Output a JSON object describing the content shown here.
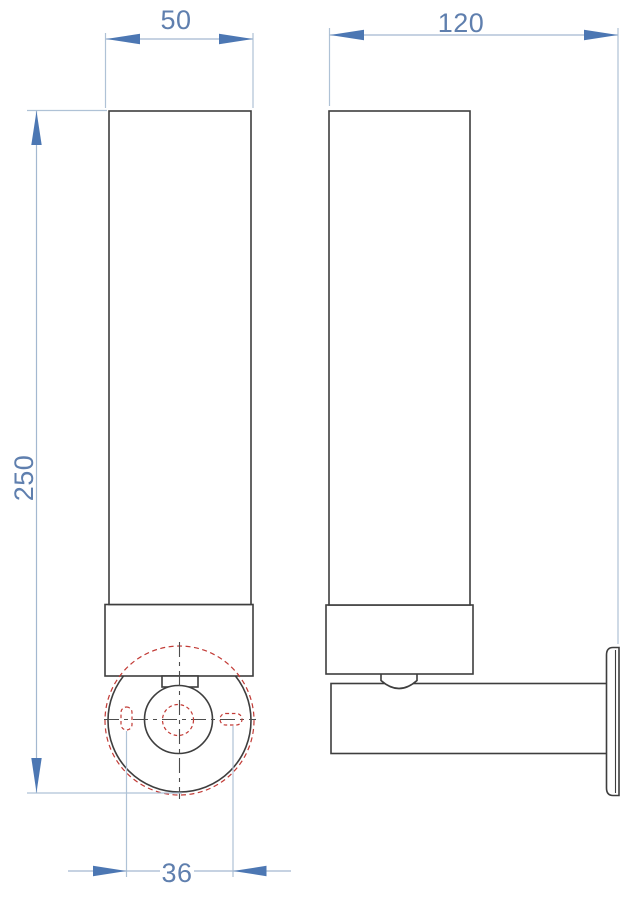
{
  "dimensions": {
    "width": "50",
    "depth": "120",
    "height": "250",
    "hole_spacing": "36"
  },
  "colors": {
    "outline": "#3e3e3e",
    "hidden_detail_red": "#c23b36",
    "centerline": "#4d4d4d",
    "dim_arrow": "#4c77b3",
    "dim_text": "#5f7fae",
    "dim_line": "#a3b8d0",
    "ext_line": "#afc2d6",
    "background": "#ffffff"
  }
}
